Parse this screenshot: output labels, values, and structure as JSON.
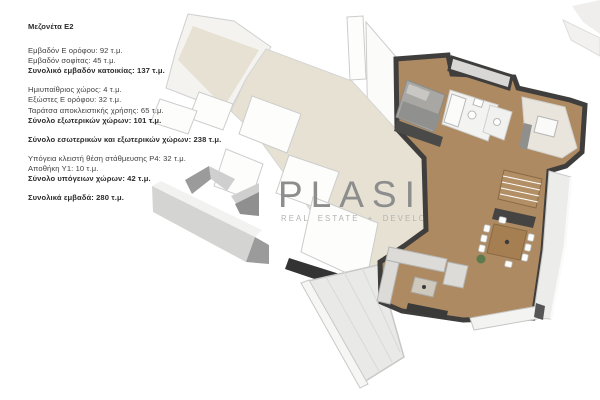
{
  "info": {
    "title": "Μεζονέτα Ε2",
    "g1": {
      "l0": "Εμβαδόν Ε ορόφου: 92 τ.μ.",
      "l1": "Εμβαδόν σοφίτας: 45 τ.μ.",
      "l2": "Συνολικό εμβαδόν κατοικίας: 137 τ.μ."
    },
    "g2": {
      "l0": "Ημιυπαίθριος χώρος: 4 τ.μ.",
      "l1": "Εξώστες Ε ορόφου: 32 τ.μ.",
      "l2": "Ταράτσα αποκλειστικής χρήσης: 65 τ.μ.",
      "l3": "Σύνολο εξωτερικών χώρων: 101 τ.μ."
    },
    "g3": {
      "l0": "Σύνολο εσωτερικών και εξωτερικών χώρων: 238 τ.μ."
    },
    "g4": {
      "l0": "Υπόγεια κλειστή θέση στάθμευσης Ρ4: 32 τ.μ.",
      "l1": "Αποθήκη Υ1: 10 τ.μ.",
      "l2": "Σύνολο υπόγειων χώρων: 42 τ.μ."
    },
    "g5": {
      "l0": "Συνολικά εμβαδά: 280 τ.μ."
    }
  },
  "watermark": {
    "brand": "PLASIS",
    "tagline": "REAL ESTATE + DEVELOPMENT"
  },
  "colors": {
    "wood": "#ad8a61",
    "dark_wall": "#3f3e3d",
    "faded_floor": "#e7e1d4",
    "faded_room": "#fdfdfc",
    "faded_wall": "#cfcfcf",
    "terrace": "#e9e9e7",
    "brand_gray": "#8d8d8d",
    "tagline_gray": "#b2b2b1",
    "bed_gray": "#a8a7a4",
    "sofa_gray": "#dcdbd8",
    "stairs_wood": "#b38f65",
    "table_wood": "#a57f52",
    "counter_dark": "#454442",
    "plant_green": "#5d7a4c"
  }
}
